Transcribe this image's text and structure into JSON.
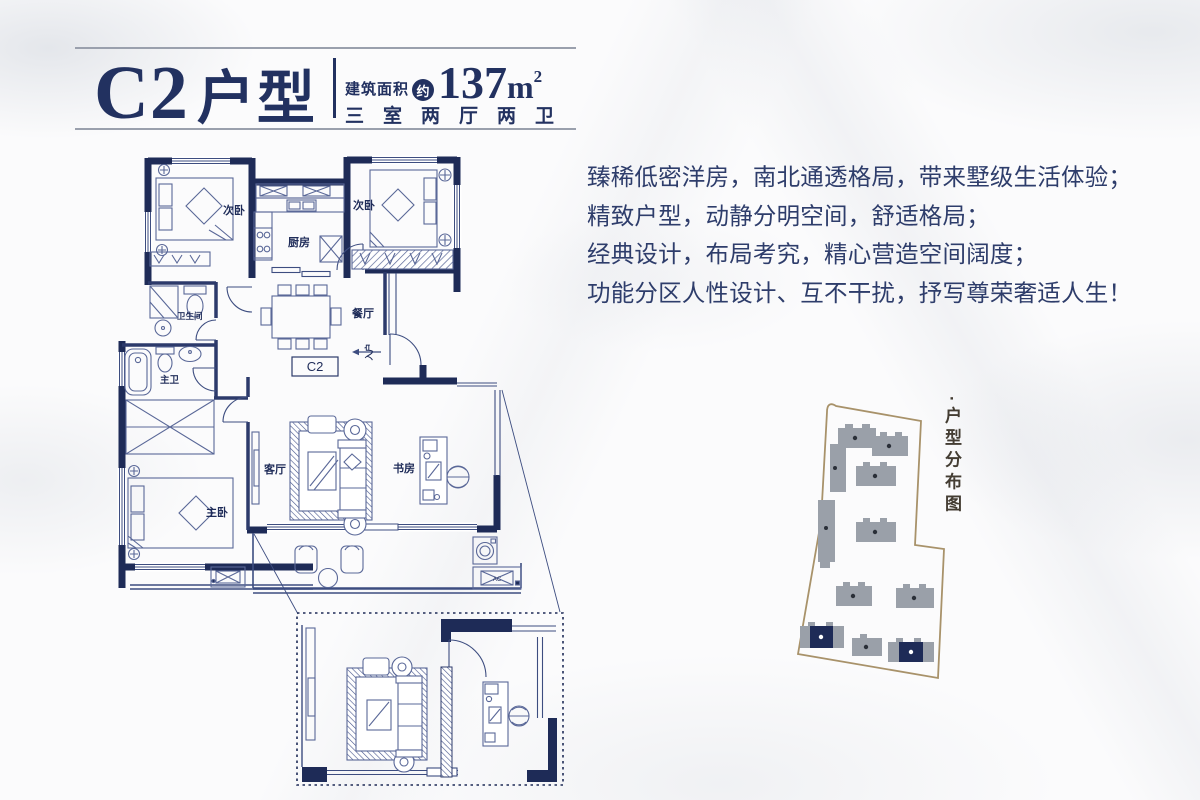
{
  "header": {
    "unit_code": "C2",
    "unit_type_suffix": "户型",
    "area_prefix": "建筑面积",
    "area_approx_badge": "约",
    "area_number": "137",
    "area_unit": "m",
    "area_exponent": "2",
    "room_spec": "三室两厅两卫"
  },
  "description": {
    "line1": "臻稀低密洋房，南北通透格局，带来墅级生活体验；",
    "line2": "精致户型，动静分明空间，舒适格局；",
    "line3": "经典设计，布局考究，精心营造空间阔度；",
    "line4": "功能分区人性设计、互不干扰，抒写尊荣奢适人生！"
  },
  "floorplan": {
    "rooms": {
      "bedroom_left": "次卧",
      "bedroom_right": "次卧",
      "kitchen": "厨房",
      "bathroom": "卫生间",
      "dining": "餐厅",
      "master_bath": "主卫",
      "master_bedroom": "主卧",
      "living": "客厅",
      "study": "书房"
    },
    "unit_label": "C2",
    "entry_label": "入户",
    "ac_label": "AC"
  },
  "siteplan": {
    "bullet": "·",
    "caption": "户型分布图"
  },
  "colors": {
    "wall_navy": "#1e2b57",
    "line_navy": "#3d4d80",
    "title_navy": "#223160",
    "text_navy": "#2e3d6b",
    "site_boundary": "#a8926a",
    "building_gray": "#9aa0a9"
  }
}
